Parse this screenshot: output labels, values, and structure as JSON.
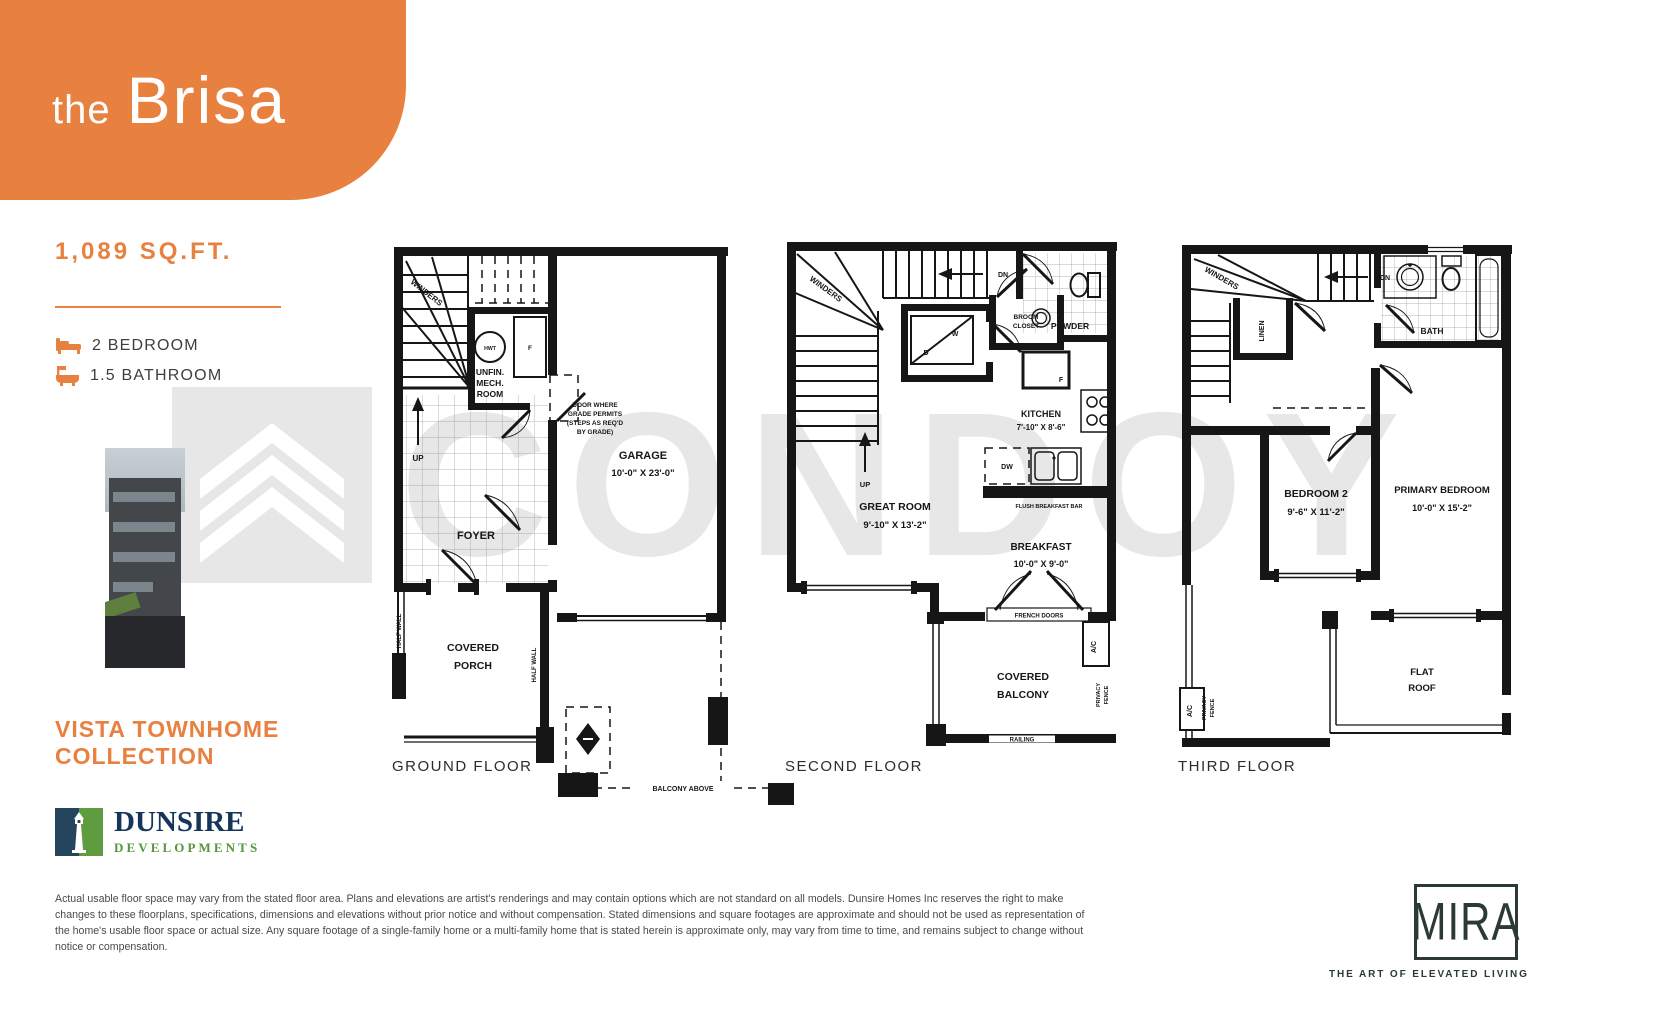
{
  "header": {
    "prefix": "the",
    "name": "Brisa"
  },
  "specs": {
    "sqft": "1,089 SQ.FT.",
    "bedrooms": "2 BEDROOM",
    "bathrooms": "1.5 BATHROOM"
  },
  "collection": {
    "line1": "VISTA TOWNHOME",
    "line2": "COLLECTION"
  },
  "developer": {
    "name": "DUNSIRE",
    "subtitle": "DEVELOPMENTS"
  },
  "watermark": {
    "text": "CONDOY"
  },
  "brand": {
    "name": "MIRA",
    "tagline": "THE ART OF ELEVATED LIVING"
  },
  "colors": {
    "accent": "#E8813F",
    "navy": "#16355A",
    "green": "#56953B",
    "plan_ink": "#161616",
    "mira": "#2C3A34",
    "watermark": "#E7E7E7"
  },
  "disclaimer": "Actual usable floor space may vary from the stated floor area. Plans and elevations are artist's renderings and may contain options which are not standard on all models. Dunsire Homes Inc reserves the right to make changes to these floorplans, specifications, dimensions and elevations without prior notice and without compensation. Stated dimensions and square footages are approximate and should not be used as representation of the home's usable floor space or actual size. Any square footage of a single-family home or a multi-family home that is stated herein is approximate only, may vary from time to time, and remains subject to change without notice or compensation.",
  "floors": {
    "ground": {
      "label": "GROUND FLOOR",
      "winders": "WINDERS",
      "up": "UP",
      "hwt": "HWT",
      "mech_l1": "UNFIN.",
      "mech_l2": "MECH.",
      "mech_l3": "ROOM",
      "furnace": "F",
      "grade_l1": "DOOR WHERE",
      "grade_l2": "GRADE PERMITS",
      "grade_l3": "(STEPS AS REQ'D",
      "grade_l4": "BY GRADE)",
      "garage": "GARAGE",
      "garage_dim": "10'-0\" X 23'-0\"",
      "foyer": "FOYER",
      "porch_l1": "COVERED",
      "porch_l2": "PORCH",
      "half_wall_left": "HALF WALL",
      "half_wall_right": "HALF WALL",
      "balcony_above": "BALCONY ABOVE"
    },
    "second": {
      "label": "SECOND FLOOR",
      "winders": "WINDERS",
      "up": "UP",
      "dn": "DN",
      "washer": "W",
      "dryer": "D",
      "broom_l1": "BROOM",
      "broom_l2": "CLOSET",
      "powder": "POWDER",
      "fridge": "F",
      "kitchen": "KITCHEN",
      "kitchen_dim": "7'-10\" X 8'-6\"",
      "dw": "DW",
      "flush_bar": "FLUSH BREAKFAST BAR",
      "great_room": "GREAT ROOM",
      "great_room_dim": "9'-10\" X 13'-2\"",
      "breakfast": "BREAKFAST",
      "breakfast_dim": "10'-0\" X 9'-0\"",
      "french_doors": "FRENCH DOORS",
      "balcony_l1": "COVERED",
      "balcony_l2": "BALCONY",
      "ac": "A/C",
      "privacy_l1": "PRIVACY",
      "privacy_l2": "FENCE",
      "railing": "RAILING"
    },
    "third": {
      "label": "THIRD FLOOR",
      "winders": "WINDERS",
      "dn": "DN",
      "linen": "LINEN",
      "bath": "BATH",
      "bedroom2": "BEDROOM 2",
      "bedroom2_dim": "9'-6\" X 11'-2\"",
      "primary": "PRIMARY BEDROOM",
      "primary_dim": "10'-0\" X 15'-2\"",
      "flat_l1": "FLAT",
      "flat_l2": "ROOF",
      "ac": "A/C",
      "privacy_l1": "PRIVACY",
      "privacy_l2": "FENCE"
    }
  }
}
